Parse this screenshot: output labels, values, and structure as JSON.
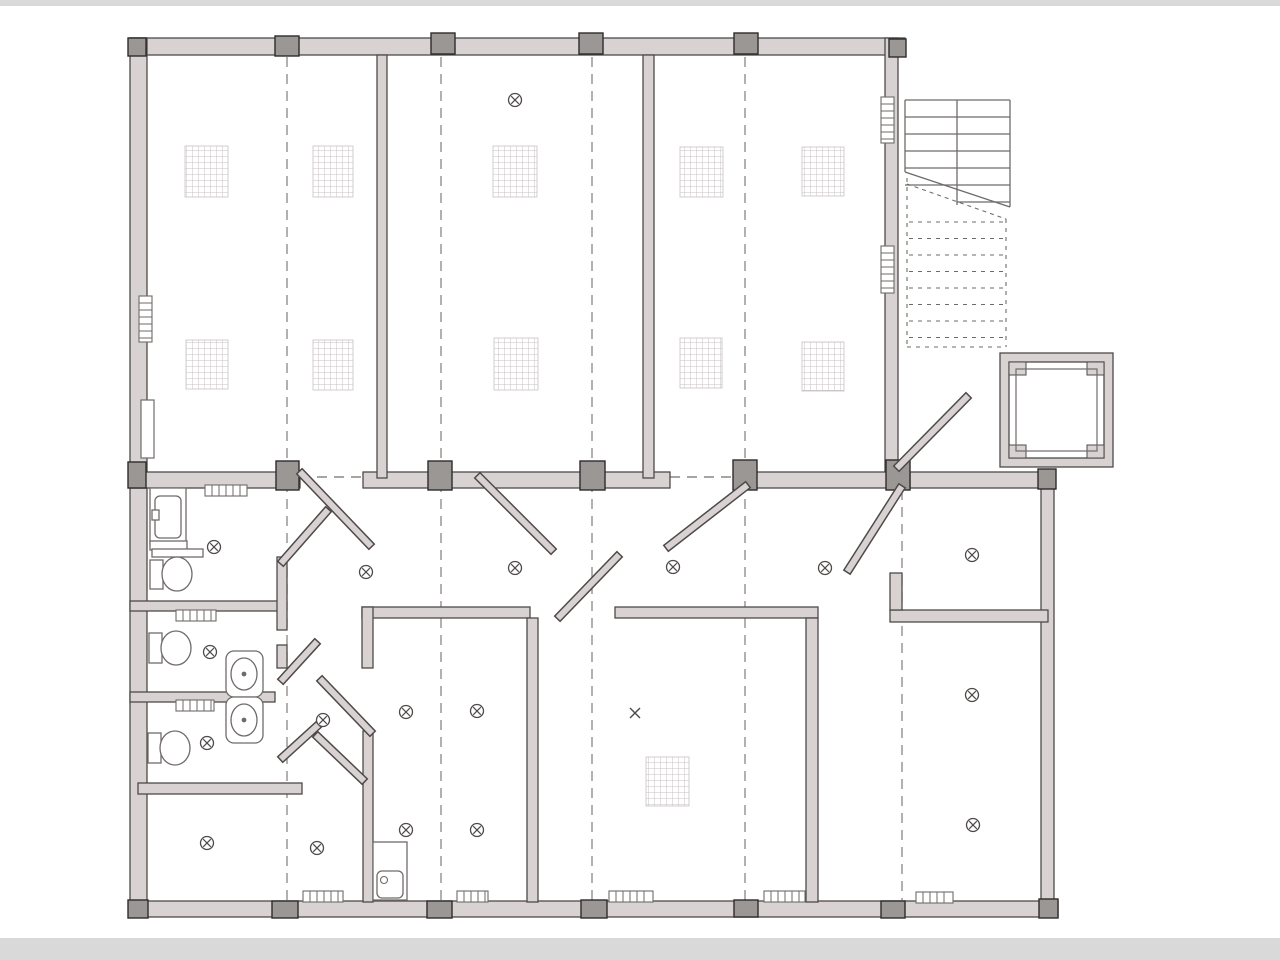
{
  "document_title": "building-floor-plan-drawing",
  "colors": {
    "background": "#ffffff",
    "band": "#d9d9d9",
    "wall_fill": "#d8d3d2",
    "wall_stroke": "#4e4a49",
    "column_fill": "#9b9795",
    "column_stroke": "#2e2b2a",
    "line": "#6f6b6a",
    "dash": "#8a8684",
    "hatch": "#c6c2c1",
    "symbol": "#4e4a49"
  },
  "page": {
    "bands": [
      [
        0,
        0,
        1280,
        6
      ],
      [
        0,
        938,
        1280,
        22
      ]
    ]
  },
  "plan": {
    "grid_axes": [
      [
        287,
        57,
        287,
        900
      ],
      [
        441,
        57,
        441,
        900
      ],
      [
        592,
        57,
        592,
        900
      ],
      [
        745,
        57,
        745,
        900
      ],
      [
        902,
        490,
        902,
        900
      ]
    ],
    "gap_dashes": [
      [
        300,
        477,
        362,
        477
      ],
      [
        670,
        477,
        734,
        477
      ]
    ],
    "walls": [
      [
        130,
        38,
        775,
        17
      ],
      [
        130,
        38,
        17,
        879
      ],
      [
        130,
        901,
        928,
        16
      ],
      [
        885,
        38,
        13,
        440
      ],
      [
        1041,
        472,
        13,
        445
      ],
      [
        130,
        472,
        170,
        16
      ],
      [
        363,
        472,
        307,
        16
      ],
      [
        735,
        472,
        158,
        16
      ],
      [
        910,
        472,
        145,
        16
      ],
      [
        377,
        55,
        10,
        423
      ],
      [
        643,
        55,
        11,
        423
      ],
      [
        130,
        601,
        148,
        10
      ],
      [
        130,
        692,
        145,
        10
      ],
      [
        138,
        783,
        164,
        11
      ],
      [
        277,
        557,
        10,
        73
      ],
      [
        277,
        645,
        10,
        23
      ],
      [
        362,
        607,
        168,
        11
      ],
      [
        362,
        607,
        11,
        61
      ],
      [
        527,
        618,
        11,
        284
      ],
      [
        615,
        607,
        203,
        11
      ],
      [
        806,
        618,
        12,
        284
      ],
      [
        363,
        731,
        10,
        171
      ],
      [
        890,
        610,
        158,
        12
      ],
      [
        890,
        573,
        12,
        37
      ]
    ],
    "columns": [
      [
        128,
        38,
        18,
        18
      ],
      [
        275,
        36,
        24,
        20
      ],
      [
        431,
        33,
        24,
        21
      ],
      [
        579,
        33,
        24,
        21
      ],
      [
        734,
        33,
        24,
        21
      ],
      [
        889,
        39,
        17,
        18
      ],
      [
        128,
        462,
        18,
        26
      ],
      [
        276,
        461,
        23,
        29
      ],
      [
        428,
        461,
        24,
        29
      ],
      [
        580,
        461,
        25,
        29
      ],
      [
        733,
        460,
        24,
        30
      ],
      [
        886,
        460,
        24,
        30
      ],
      [
        1038,
        469,
        18,
        20
      ],
      [
        128,
        900,
        20,
        18
      ],
      [
        272,
        901,
        26,
        17
      ],
      [
        427,
        901,
        25,
        17
      ],
      [
        581,
        900,
        26,
        18
      ],
      [
        734,
        900,
        24,
        17
      ],
      [
        881,
        901,
        24,
        17
      ],
      [
        1039,
        899,
        19,
        19
      ]
    ],
    "door_leaves": [
      [
        302,
        474,
        369,
        544
      ],
      [
        283,
        561,
        326,
        512
      ],
      [
        480,
        478,
        551,
        549
      ],
      [
        560,
        616,
        617,
        557
      ],
      [
        745,
        487,
        669,
        546
      ],
      [
        900,
        489,
        849,
        569
      ],
      [
        899,
        466,
        966,
        398
      ],
      [
        283,
        679,
        315,
        644
      ],
      [
        322,
        681,
        370,
        731
      ],
      [
        318,
        737,
        362,
        779
      ],
      [
        283,
        757,
        316,
        727
      ]
    ],
    "ceiling_panels": [
      [
        185,
        146,
        43,
        51
      ],
      [
        313,
        146,
        40,
        51
      ],
      [
        493,
        146,
        44,
        51
      ],
      [
        680,
        147,
        43,
        50
      ],
      [
        802,
        147,
        42,
        49
      ],
      [
        186,
        340,
        42,
        49
      ],
      [
        313,
        340,
        40,
        50
      ],
      [
        494,
        338,
        44,
        52
      ],
      [
        680,
        338,
        42,
        50
      ],
      [
        802,
        342,
        42,
        49
      ],
      [
        646,
        757,
        43,
        49
      ]
    ],
    "grilles": [
      [
        205,
        485,
        42,
        11
      ],
      [
        176,
        610,
        40,
        11
      ],
      [
        176,
        700,
        38,
        11
      ],
      [
        303,
        891,
        40,
        11
      ],
      [
        457,
        891,
        31,
        11
      ],
      [
        609,
        891,
        44,
        11
      ],
      [
        764,
        891,
        41,
        11
      ],
      [
        916,
        892,
        37,
        11
      ]
    ],
    "windows": [
      [
        881,
        97,
        13,
        46
      ],
      [
        881,
        246,
        13,
        47
      ],
      [
        139,
        296,
        13,
        46
      ]
    ],
    "niches": [
      [
        141,
        400,
        13,
        58
      ]
    ],
    "ceiling_symbols": [
      [
        515,
        100
      ],
      [
        214,
        547
      ],
      [
        366,
        572
      ],
      [
        515,
        568
      ],
      [
        673,
        567
      ],
      [
        825,
        568
      ],
      [
        972,
        555
      ],
      [
        210,
        652
      ],
      [
        207,
        743
      ],
      [
        323,
        720
      ],
      [
        406,
        712
      ],
      [
        477,
        711
      ],
      [
        406,
        830
      ],
      [
        477,
        830
      ],
      [
        207,
        843
      ],
      [
        317,
        848
      ],
      [
        972,
        695
      ],
      [
        973,
        825
      ]
    ],
    "x_markers": [
      [
        635,
        713
      ]
    ],
    "stairs": {
      "left": 905,
      "right": 1010,
      "top": 100,
      "treads": [
        117,
        134,
        151,
        168,
        185
      ],
      "half_tread": 202,
      "stringer": 957,
      "left_bottom": 172,
      "right_bottom": 207,
      "diag": [
        905,
        172,
        1010,
        207
      ],
      "diag2": [
        907,
        184,
        1006,
        219
      ],
      "dash_left": 907,
      "dash_right": 1006,
      "dash_top": 178,
      "dash_bottom": 347,
      "dash_treads_y0": 222,
      "dash_treads_step": 16.5,
      "dash_treads_n": 8
    },
    "elevator": {
      "outer": [
        1000,
        353,
        113,
        114
      ],
      "ring": [
        1009,
        362,
        95,
        96
      ],
      "inner": [
        1016,
        369,
        81,
        82
      ],
      "pads": [
        [
          1009,
          362,
          17,
          13
        ],
        [
          1087,
          362,
          17,
          13
        ],
        [
          1009,
          445,
          17,
          13
        ],
        [
          1087,
          445,
          17,
          13
        ]
      ]
    },
    "fixtures": {
      "shower": {
        "body": [
          150,
          488,
          36,
          57
        ],
        "tray": [
          155,
          496,
          26,
          42
        ],
        "handle": [
          152,
          510,
          7,
          10
        ],
        "base": [
          150,
          541,
          37,
          9
        ],
        "shelf": [
          152,
          549,
          51,
          8
        ]
      },
      "toilets": [
        {
          "tank": [
            150,
            560,
            13,
            29
          ],
          "bowl": [
            177,
            574,
            15,
            17
          ]
        },
        {
          "tank": [
            149,
            633,
            13,
            30
          ],
          "bowl": [
            176,
            648,
            15,
            17
          ]
        },
        {
          "tank": [
            148,
            733,
            13,
            30
          ],
          "bowl": [
            175,
            748,
            15,
            17
          ]
        }
      ],
      "sinks": [
        {
          "body": [
            226,
            651,
            37,
            46
          ],
          "basin": [
            244,
            674,
            13,
            16
          ]
        },
        {
          "body": [
            226,
            697,
            37,
            46
          ],
          "basin": [
            244,
            720,
            13,
            16
          ]
        }
      ],
      "heater": {
        "body": [
          373,
          842,
          34,
          58
        ],
        "inner": [
          377,
          871,
          26,
          27
        ],
        "knob": [
          384,
          880,
          3.5
        ]
      }
    }
  }
}
